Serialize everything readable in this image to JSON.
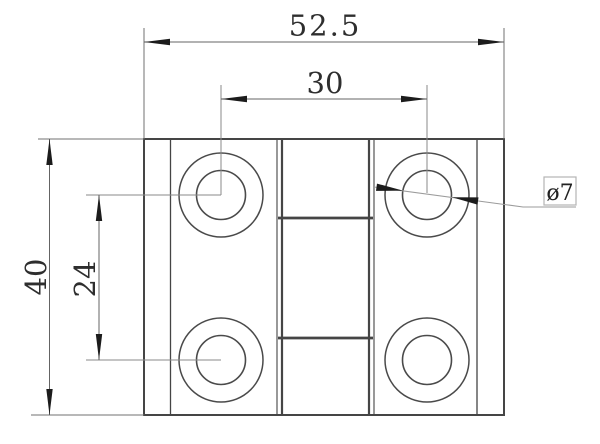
{
  "drawing": {
    "kind": "engineering-dimension-drawing",
    "part": "hinge-front-view"
  },
  "dimensions": {
    "overall_width": "52.5",
    "hole_pitch_horizontal": "30",
    "overall_height": "40",
    "hole_pitch_vertical": "24",
    "hole_diameter": "ø7"
  },
  "colors": {
    "background": "#ffffff",
    "part_lines": "#454545",
    "dimension_lines": "#646464",
    "arrowheads": "#1c1c1c",
    "leader_line": "#9b9b9b",
    "label_box_border": "#b4b4b4",
    "text": "#2e2e2e"
  }
}
